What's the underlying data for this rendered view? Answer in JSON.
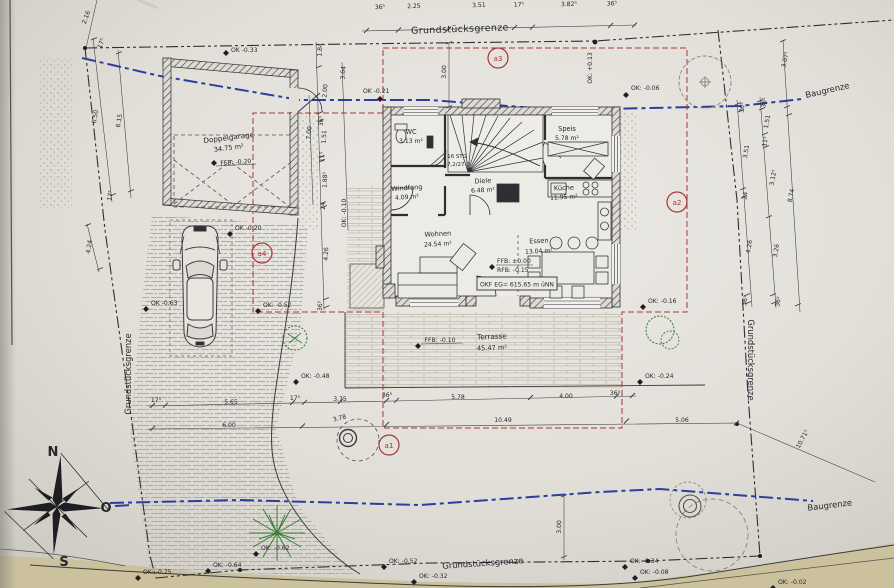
{
  "plan": {
    "boundaries": {
      "grundstuecksgrenze_top": "Grundstücksgrenze",
      "grundstuecksgrenze_left": "Grundstücksgrenze",
      "grundstuecksgrenze_right": "Grundstücksgrenze",
      "grundstuecksgrenze_bottom": "Grundstücksgrenze",
      "baugrenze_top": "Baugrenze",
      "baugrenze_bottom": "Baugrenze"
    },
    "compass": {
      "north": "N",
      "east": "O",
      "south": "S"
    },
    "markers": [
      "a1",
      "a2",
      "a3",
      "a4"
    ],
    "rooms": [
      {
        "name": "WC",
        "area": "3.13 m²"
      },
      {
        "name": "Speis",
        "area": "5.78 m²"
      },
      {
        "name": "Windfang",
        "area": "4.09 m²"
      },
      {
        "name": "Diele",
        "area": "6.48 m²"
      },
      {
        "name": "Küche",
        "area": "11.95 m²"
      },
      {
        "name": "Wohnen",
        "area": "24.54 m²"
      },
      {
        "name": "Essen",
        "area": "13.04 m²"
      }
    ],
    "garage": {
      "name": "Doppelgarage",
      "area": "34.75 m²",
      "level": "FFB: -0.20"
    },
    "terrace": {
      "name": "Terrasse",
      "area": "45.47 m²",
      "level": "FFB: -0.10"
    },
    "stairs": {
      "line1": "16 STG",
      "line2": "17,2/27 D"
    },
    "levels": {
      "ffb": "FFB: ±0.00",
      "rfb": "RFB: -0.15",
      "okf": "OKF EG= 615.65 m üNN"
    },
    "elevations": {
      "garage_top": "OK -0.33",
      "house_top_left": "OK -0.21",
      "house_top_right": "OK: -0.06",
      "boundary_top_right": "OK: +0.13",
      "garage_apron": "OK -0.20",
      "drive_left": "OK -0.63",
      "drive_right": "OK: -0.52",
      "terrace_left": "OK: -0.48",
      "terrace_right": "OK: -0.24",
      "house_bottom_right": "OK: -0.16",
      "entry_path": "OK: -0.10",
      "street_far_left": "OK: -0.75",
      "street_left": "OK: -0.64",
      "plant_bottom": "OK: -0.62",
      "street_mid": "OK: -0.52",
      "street_mid2": "OK: -0.32",
      "street_right": "OK: -0.34",
      "street_right2": "OK: -0.08",
      "street_corner": "OK: -0.02"
    },
    "dims": {
      "top": [
        "36⁵",
        "2.25",
        "3.51",
        "17⁵",
        "3.82⁵",
        "36⁵"
      ],
      "left": [
        "2.16",
        "17⁵",
        "6.50",
        "6.15",
        "17⁵",
        "4.24"
      ],
      "house_left": [
        "1.84",
        "3.64",
        "2.00",
        "7.00",
        "36⁵",
        "1.51",
        "11⁵",
        "1.88⁵",
        "24",
        "4.26",
        "36⁵"
      ],
      "bottom_row1": [
        "17⁵",
        "5.65",
        "17⁵",
        "3.75",
        "36⁵",
        "5.78",
        "4.00",
        "36⁵"
      ],
      "bottom_row2": [
        "6.00",
        "3.78",
        "10.49",
        "5.06"
      ],
      "right_chain1": [
        "36⁵",
        "3.51",
        "24",
        "4.26",
        "36⁵"
      ],
      "right_chain2": [
        "36⁵",
        "1.51",
        "11⁵",
        "3.12⁵",
        "3.26",
        "36⁵"
      ],
      "right_chain3": [
        "3.07⁵",
        "8.74",
        "10.71⁵"
      ],
      "offsets": [
        "3.00",
        "3.00"
      ]
    }
  }
}
